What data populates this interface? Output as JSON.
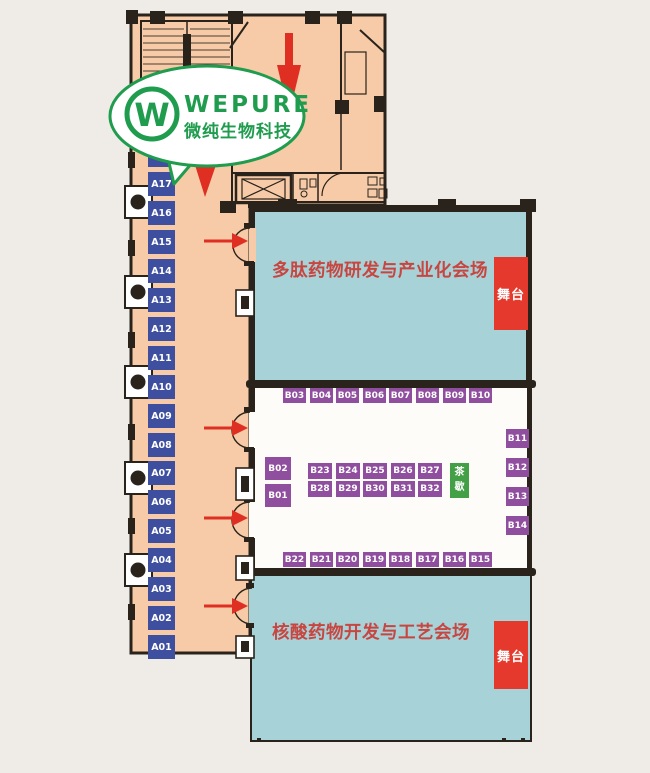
{
  "logo": {
    "brand": "WEPURE",
    "subtitle": "微纯生物科技",
    "monogram": "W"
  },
  "halls": {
    "top": {
      "title": "多肽药物研发与产业化会场",
      "stage": "舞台"
    },
    "bottom": {
      "title": "核酸药物开发与工艺会场",
      "stage": "舞台"
    }
  },
  "tea_break": "茶歇",
  "booths": {
    "a_column": [
      "A18",
      "A17",
      "A16",
      "A15",
      "A14",
      "A13",
      "A12",
      "A11",
      "A10",
      "A09",
      "A08",
      "A07",
      "A06",
      "A05",
      "A04",
      "A03",
      "A02",
      "A01"
    ],
    "b_top_row": [
      "B03",
      "B04",
      "B05",
      "B06",
      "B07",
      "B08",
      "B09",
      "B10"
    ],
    "b_right_column": [
      "B11",
      "B12",
      "B13",
      "B14"
    ],
    "b_bottom_row": [
      "B22",
      "B21",
      "B20",
      "B19",
      "B18",
      "B17",
      "B16",
      "B15"
    ],
    "b_left_column": [
      "B02",
      "B01"
    ],
    "b_center_row1": [
      "B23",
      "B24",
      "B25",
      "B26",
      "B27"
    ],
    "b_center_row2": [
      "B28",
      "B29",
      "B30",
      "B31",
      "B32"
    ]
  },
  "colors": {
    "page-bg": "#efece7",
    "floor": "#f7cba7",
    "wall": "#2a231b",
    "booth-a": "#3e4f9f",
    "booth-b": "#8f4f9e",
    "teal": "#a6d2d8",
    "white-zone": "#fdfcf9",
    "stage-red": "#e6392d",
    "title-red": "#c84540",
    "tea-green": "#44a047",
    "arrow-red": "#df2f23",
    "logo-green": "#1f9c4e"
  }
}
